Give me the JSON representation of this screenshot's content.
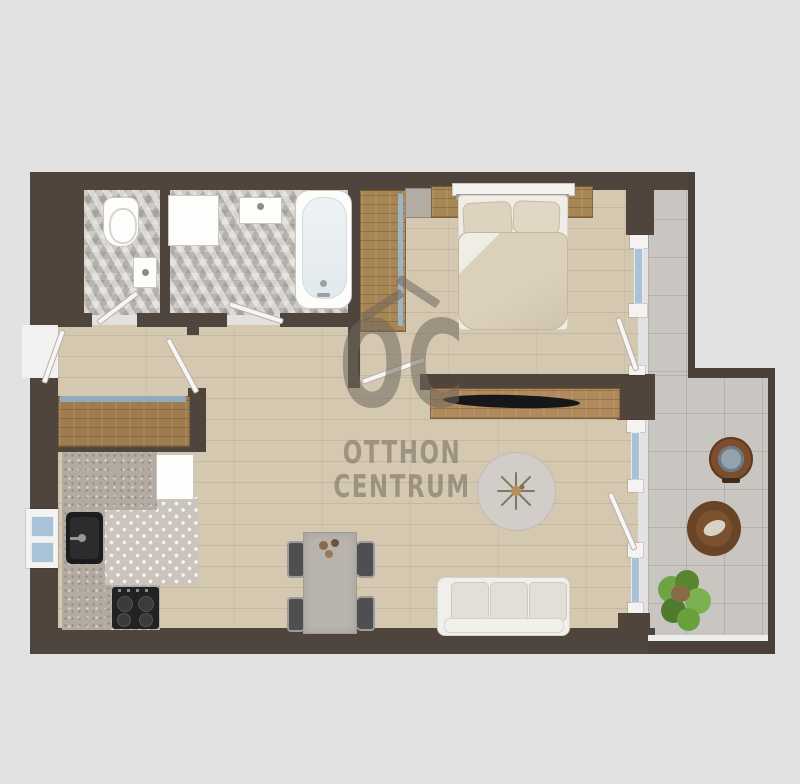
{
  "watermark": {
    "monogram": "OC",
    "line1": "OTTHON",
    "line2": "CENTRUM",
    "color_hex": "#70675d"
  },
  "palette": {
    "background": "#e3e2e2",
    "wall": "#50453d",
    "wall_thin": "#4a4038",
    "floor_wood": "#d5c8b1",
    "floor_dark_wood": "#a78655",
    "tile_terrace": "#c9c6c2",
    "glass": "#a9c2d7",
    "counter": "#b3aaa2",
    "sofa": "#eff0ec",
    "appliance_dark": "#222224"
  },
  "floorplan": {
    "type": "apartment-top-view-render",
    "rooms": [
      "entry-hall",
      "wc",
      "bathroom",
      "bedroom",
      "living-room-with-kitchen",
      "terrace"
    ],
    "furniture": [
      "toilet",
      "wc-sink",
      "shower-base",
      "bath-sink",
      "bathtub",
      "built-in-wardrobe",
      "dresser",
      "double-bed",
      "nightstand-left",
      "nightstand-right",
      "tv-console",
      "tv",
      "hall-closet",
      "kitchen-counter",
      "kitchen-sink",
      "fridge",
      "stove",
      "dining-table",
      "dining-chair",
      "sofa",
      "round-rug",
      "plant-on-rug",
      "terrace-table",
      "terrace-lounge-chair",
      "terrace-plant"
    ],
    "doors": [
      "entry-door",
      "hall-door",
      "wc-door",
      "bathroom-door",
      "bedroom-door",
      "bedroom-terrace-door",
      "living-terrace-door"
    ],
    "windows": [
      "kitchen-window",
      "bedroom-terrace-window",
      "living-terrace-window"
    ]
  }
}
